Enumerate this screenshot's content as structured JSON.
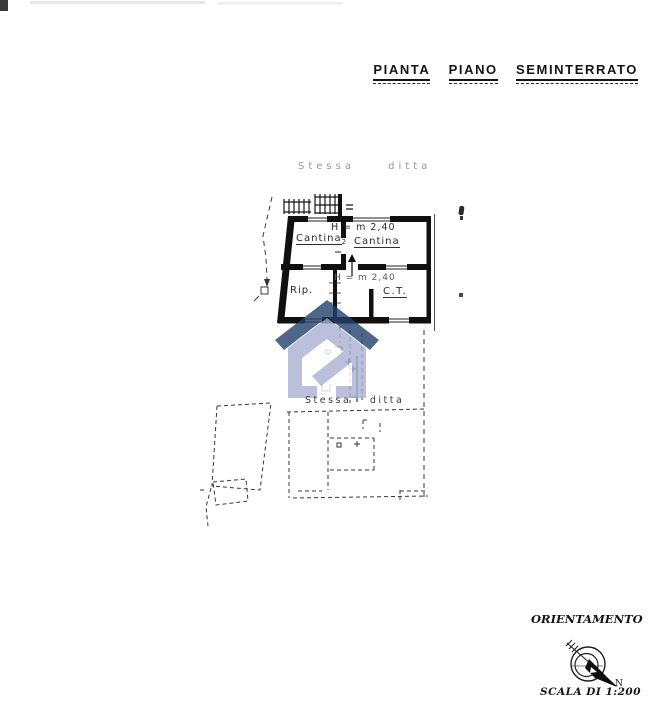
{
  "title": {
    "words": [
      "PIANTA",
      "PIANO",
      "SEMINTERRATO"
    ]
  },
  "plan": {
    "site_note_upper": "Stessa ditta",
    "site_note_lower": "Stessa ditta",
    "height_note_upper": "H = m 2,40",
    "height_note_lower": "H = m 2,40",
    "rooms": [
      {
        "label": "Cantina",
        "sub": "2"
      },
      {
        "label": "Cantina"
      },
      {
        "label": "Rip."
      },
      {
        "label": "C.T."
      }
    ]
  },
  "compass": {
    "heading": "ORIENTAMENTO",
    "north_label": "N"
  },
  "scale_note": "SCALA DI 1:200",
  "colors": {
    "ink": "#111111",
    "faint_ink": "#979797",
    "watermark_body": "#a9b1d4",
    "watermark_roof": "#24406f"
  },
  "watermark_icon": "house-logo"
}
